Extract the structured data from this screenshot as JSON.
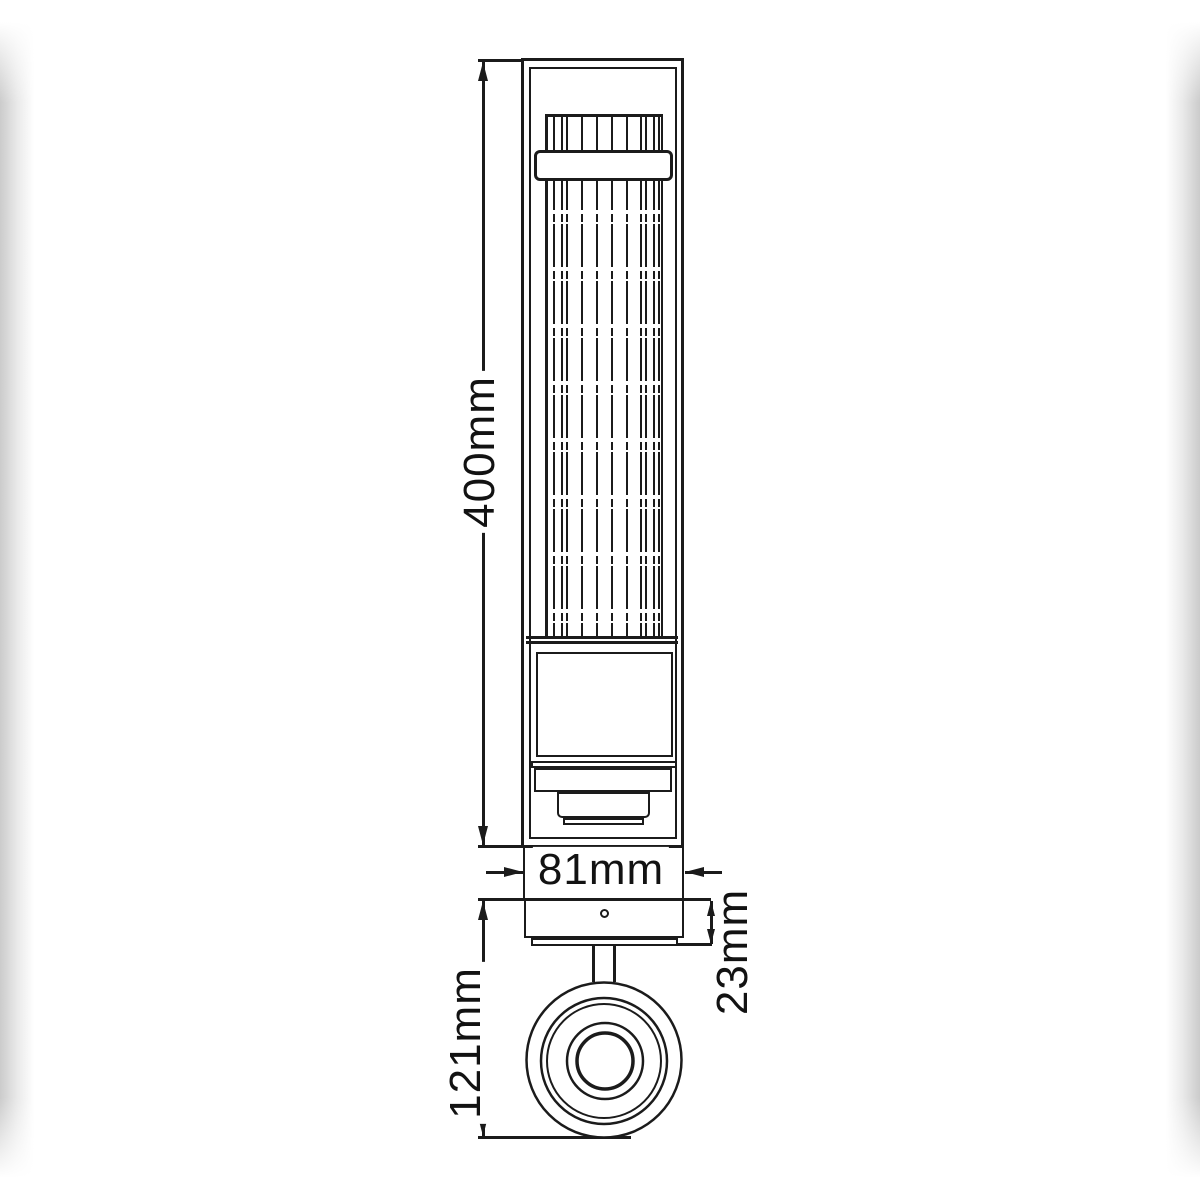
{
  "drawing": {
    "type": "technical-dimension-diagram",
    "subject": "wall-light-fixture",
    "colors": {
      "background": "#ffffff",
      "line": "#1b1b1b",
      "label_text": "#121212",
      "edge_shadow": "#cbcbcb"
    },
    "dimensions": {
      "height": {
        "value": "400mm",
        "orientation": "vertical"
      },
      "width": {
        "value": "81mm",
        "orientation": "horizontal"
      },
      "depth": {
        "value": "121mm",
        "orientation": "vertical"
      },
      "plate_thickness": {
        "value": "23mm",
        "orientation": "vertical"
      }
    }
  }
}
